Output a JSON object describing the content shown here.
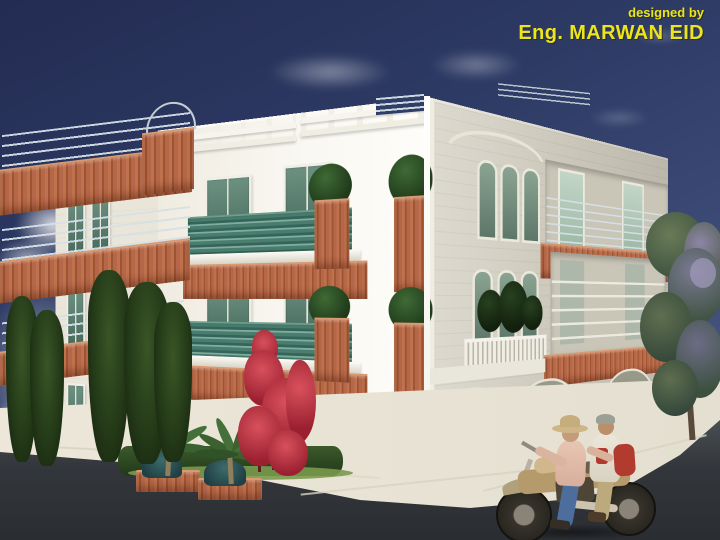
{
  "credit": {
    "prefix": "designed by",
    "name": "Eng. MARWAN EID",
    "text_color": "#ece41d"
  },
  "scene": {
    "type": "3D architectural rendering",
    "subject": "Three-storey residential building viewed from a street corner",
    "storeys": 3,
    "garage_doors": 3,
    "palette": {
      "sky_top": "#232c52",
      "sky_bottom": "#51618c",
      "sunlit_facade": "#f7f4ed",
      "shaded_facade": "#d5d1c4",
      "terracotta_balcony": "#b4674a",
      "balcony_glass_green": "#3f7265",
      "window_glass": "#5d8374",
      "garage_door": "#8f9381",
      "road": "#33373c",
      "sidewalk": "#e9e4d6"
    },
    "elements": [
      "terracotta balconies with metal pipe railings",
      "green glass balcony parapets",
      "rooftop pergolas",
      "triple arched windows",
      "arched garage doors",
      "cypress trees",
      "red bougainvillea",
      "palm planter beds",
      "street tree",
      "motorcycle with two riders"
    ]
  }
}
